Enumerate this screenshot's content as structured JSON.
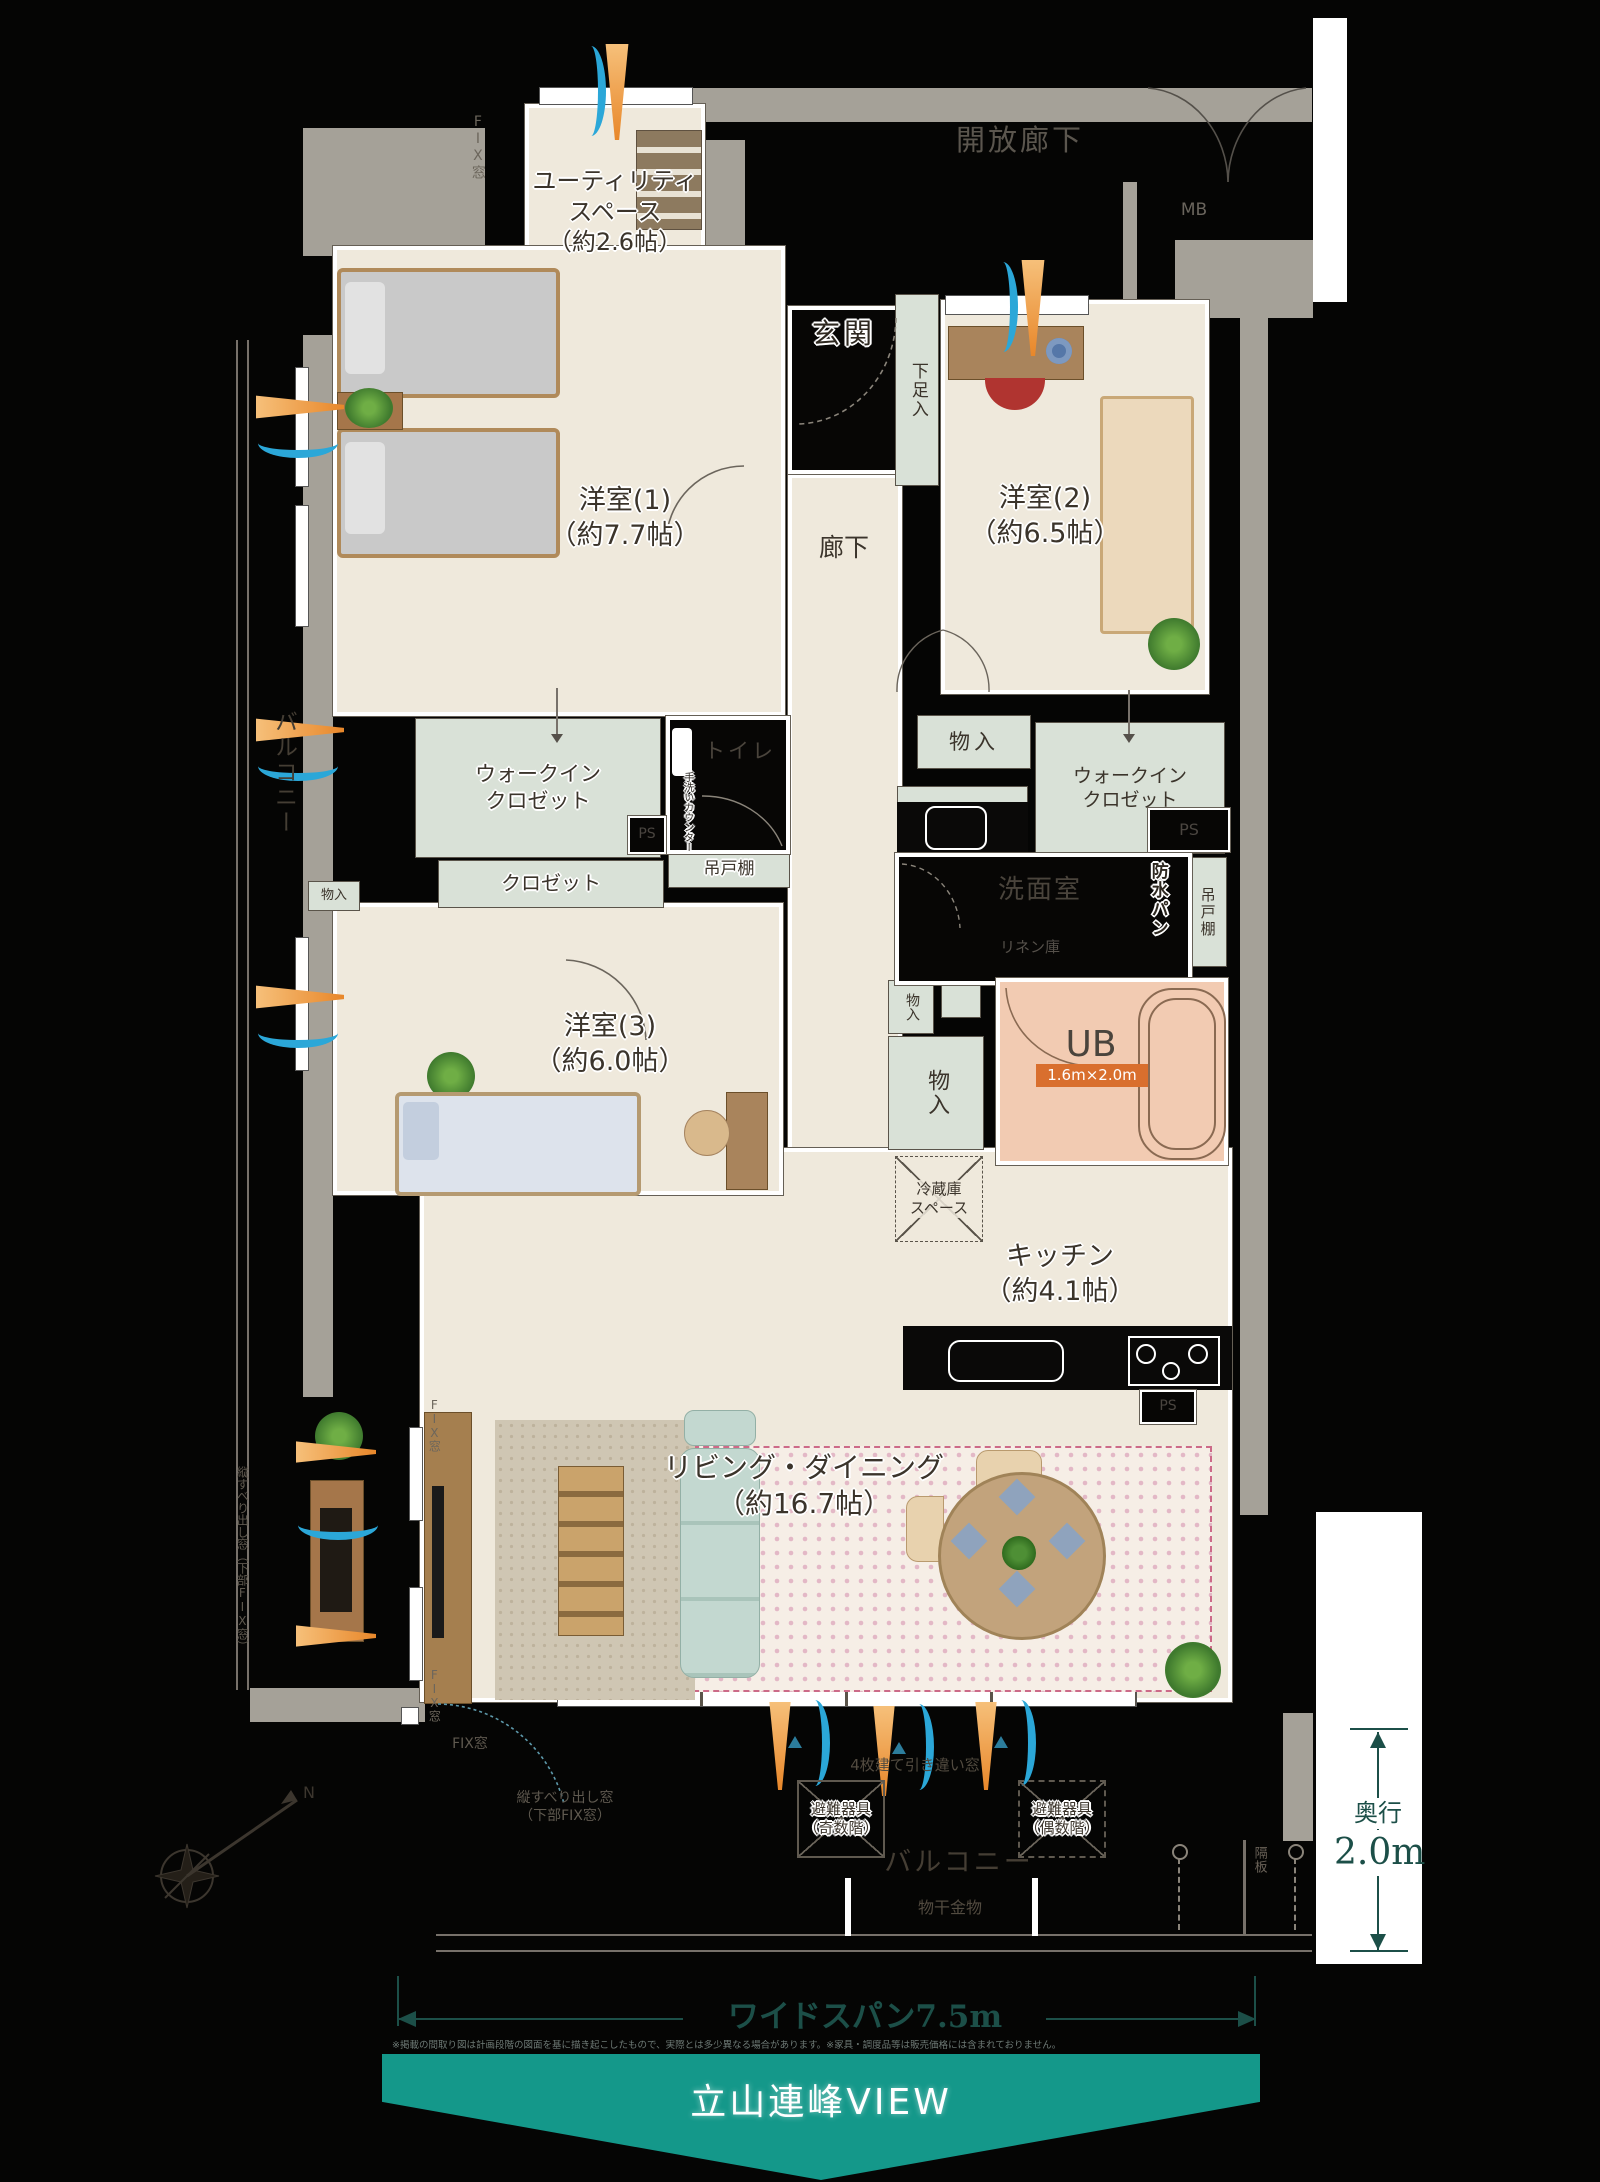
{
  "labels": {
    "open_corridor": "開放廊下",
    "mb": "MB",
    "fix_window": "FIX窓",
    "utility_1": "ユーティリティ",
    "utility_2": "スペース",
    "utility_3": "（約2.6帖）",
    "genkan": "玄関",
    "shoe_box": "下足入",
    "hallway": "廊下",
    "room1_name": "洋室(1)",
    "room1_size": "（約7.7帖）",
    "room2_name": "洋室(2)",
    "room2_size": "（約6.5帖）",
    "room3_name": "洋室(3)",
    "room3_size": "（約6.0帖）",
    "wic_1": "ウォークイン",
    "wic_2": "クロゼット",
    "closet": "クロゼット",
    "ps": "PS",
    "toilet": "トイレ",
    "hand_wash_counter": "手洗いカウンター",
    "hanging_cupboard": "吊戸棚",
    "washroom": "洗面室",
    "linen": "リネン庫",
    "waterproof_pan": "防水パン",
    "storage": "物入",
    "ub": "UB",
    "ub_size": "1.6m×2.0m",
    "fridge_1": "冷蔵庫",
    "fridge_2": "スペース",
    "kitchen_name": "キッチン",
    "kitchen_size": "（約4.1帖）",
    "living_name": "リビング・ダイニング",
    "living_size": "（約16.7帖）",
    "balcony": "バルコニー",
    "laundry_hardware": "物干金物",
    "evac_odd_1": "避難器具",
    "evac_odd_2": "（奇数階）",
    "evac_even_1": "避難器具",
    "evac_even_2": "（偶数階）",
    "sliding_window4": "4枚建て引き違い窓",
    "partition": "隔板",
    "tate_window_1": "縦すべり出し窓",
    "tate_window_2": "（下部FIX窓）",
    "compass_n": "N"
  },
  "dimensions": {
    "depth_label": "奥行",
    "depth_value": "2.0m",
    "wide_span": "ワイドスパン7.5m"
  },
  "banner": {
    "view": "立山連峰VIEW"
  },
  "disclaimer": "※掲載の間取り図は計画段階の図面を基に描き起こしたもので、実際とは多少異なる場合があります。※家具・調度品等は販売価格には含まれておりません。",
  "colors": {
    "banner_teal": "#14988a",
    "dimension_teal": "#1c4f48",
    "arrow_orange": "#e8872a",
    "arrow_blue": "#2ba7d8",
    "ub_tag_orange": "#d96f2e"
  }
}
